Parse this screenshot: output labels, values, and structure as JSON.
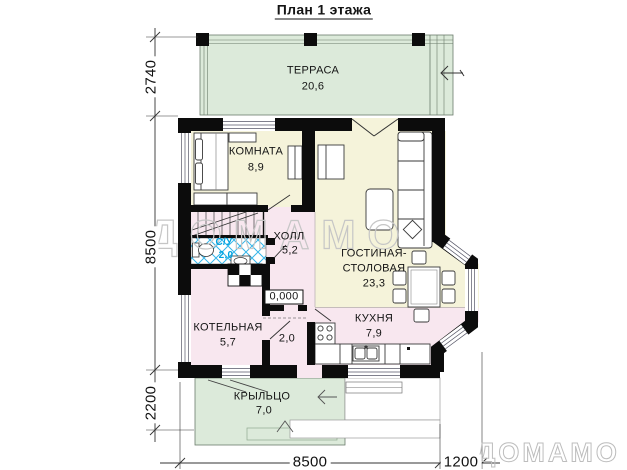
{
  "title": "План 1 этажа",
  "rooms": {
    "terrace": {
      "name": "ТЕРРАСА",
      "area": "20,6"
    },
    "room": {
      "name": "КОМНАТА",
      "area": "8,9"
    },
    "hall": {
      "name": "ХОЛЛ",
      "area": "5,2"
    },
    "bathroom": {
      "name": "С/У",
      "area": "2,0"
    },
    "living": {
      "name_line1": "ГОСТИНАЯ-",
      "name_line2": "СТОЛОВАЯ",
      "area": "23,3"
    },
    "boiler": {
      "name": "КОТЕЛЬНАЯ",
      "area": "5,7"
    },
    "vestibule": {
      "area": "2,0"
    },
    "kitchen": {
      "name": "КУХНЯ",
      "area": "7,9"
    },
    "porch": {
      "name": "КРЫЛЬЦО",
      "area": "7,0"
    }
  },
  "marks": {
    "elevation": "0,000"
  },
  "dimensions": {
    "left": {
      "terrace": "2740",
      "house": "8500",
      "porch": "2200"
    },
    "bottom": {
      "house": "8500",
      "bay": "1200"
    }
  },
  "watermark": {
    "center": "ДОМАМО",
    "corner": "ДОМАМО"
  },
  "colors": {
    "terrace_fill": "#dceada",
    "room_fill": "#f5f3da",
    "service_fill": "#f8e7ef",
    "tile_blue": "#35b6ea",
    "wall": "#0c0c0c",
    "bathroom_label": "#00a3e0",
    "watermark": "#c6c6c6"
  }
}
